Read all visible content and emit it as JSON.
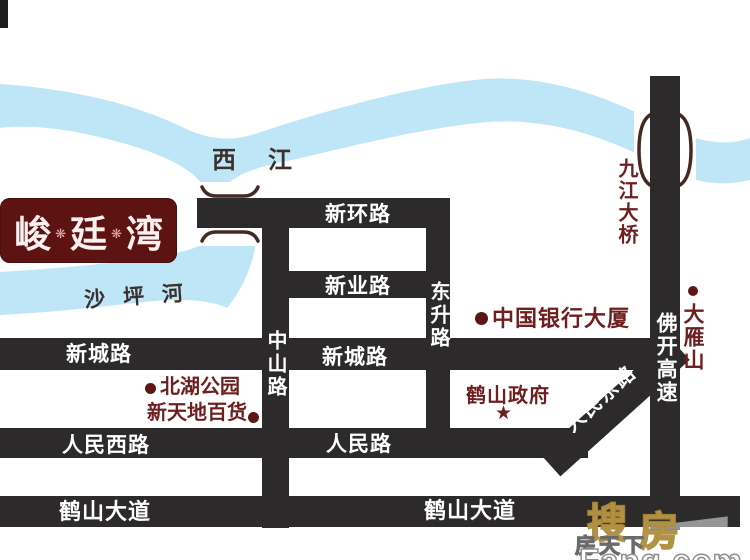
{
  "logo": {
    "chars": [
      "峻",
      "廷",
      "湾"
    ],
    "separator": "❋"
  },
  "rivers": {
    "xijiang": {
      "label": "西江"
    },
    "shapinghe": {
      "label": "沙坪河"
    }
  },
  "roads": {
    "xinhuan": {
      "label": "新环路"
    },
    "xinye": {
      "label": "新业路"
    },
    "xincheng": {
      "label_west": "新城路",
      "label_mid": "新城路"
    },
    "renminxi": {
      "label": "人民西路"
    },
    "renmin": {
      "label": "人民路"
    },
    "renmindong": {
      "label": "人民东路"
    },
    "heshan": {
      "label_west": "鹤山大道",
      "label_mid": "鹤山大道"
    },
    "zhongshan": {
      "label": "中山路"
    },
    "dongsheng": {
      "label": "东升路"
    },
    "fokai": {
      "label": "佛开高速"
    },
    "jiujiang_bridge": {
      "label": "九江大桥"
    }
  },
  "pois": {
    "bank": {
      "label": "中国银行大厦",
      "marker": "dot"
    },
    "dayanshan": {
      "label": "大雁山",
      "marker": "dot"
    },
    "beihu_park": {
      "label": "北湖公园",
      "marker": "dot"
    },
    "xintiandi": {
      "label": "新天地百货",
      "marker": "dot"
    },
    "government": {
      "label": "鹤山政府",
      "marker": "star",
      "marker_glyph": "★"
    }
  },
  "watermark": {
    "cn1": "搜",
    "cn2": "房",
    "mid": "房天下",
    "en": "Fang.com"
  },
  "colors": {
    "road": "#2d2a2b",
    "river": "#bfe6f7",
    "poi_text": "#6e2020",
    "logo_bg": "#5e1313",
    "water_label": "#3a312e",
    "bridge_mark": "#452a22"
  }
}
